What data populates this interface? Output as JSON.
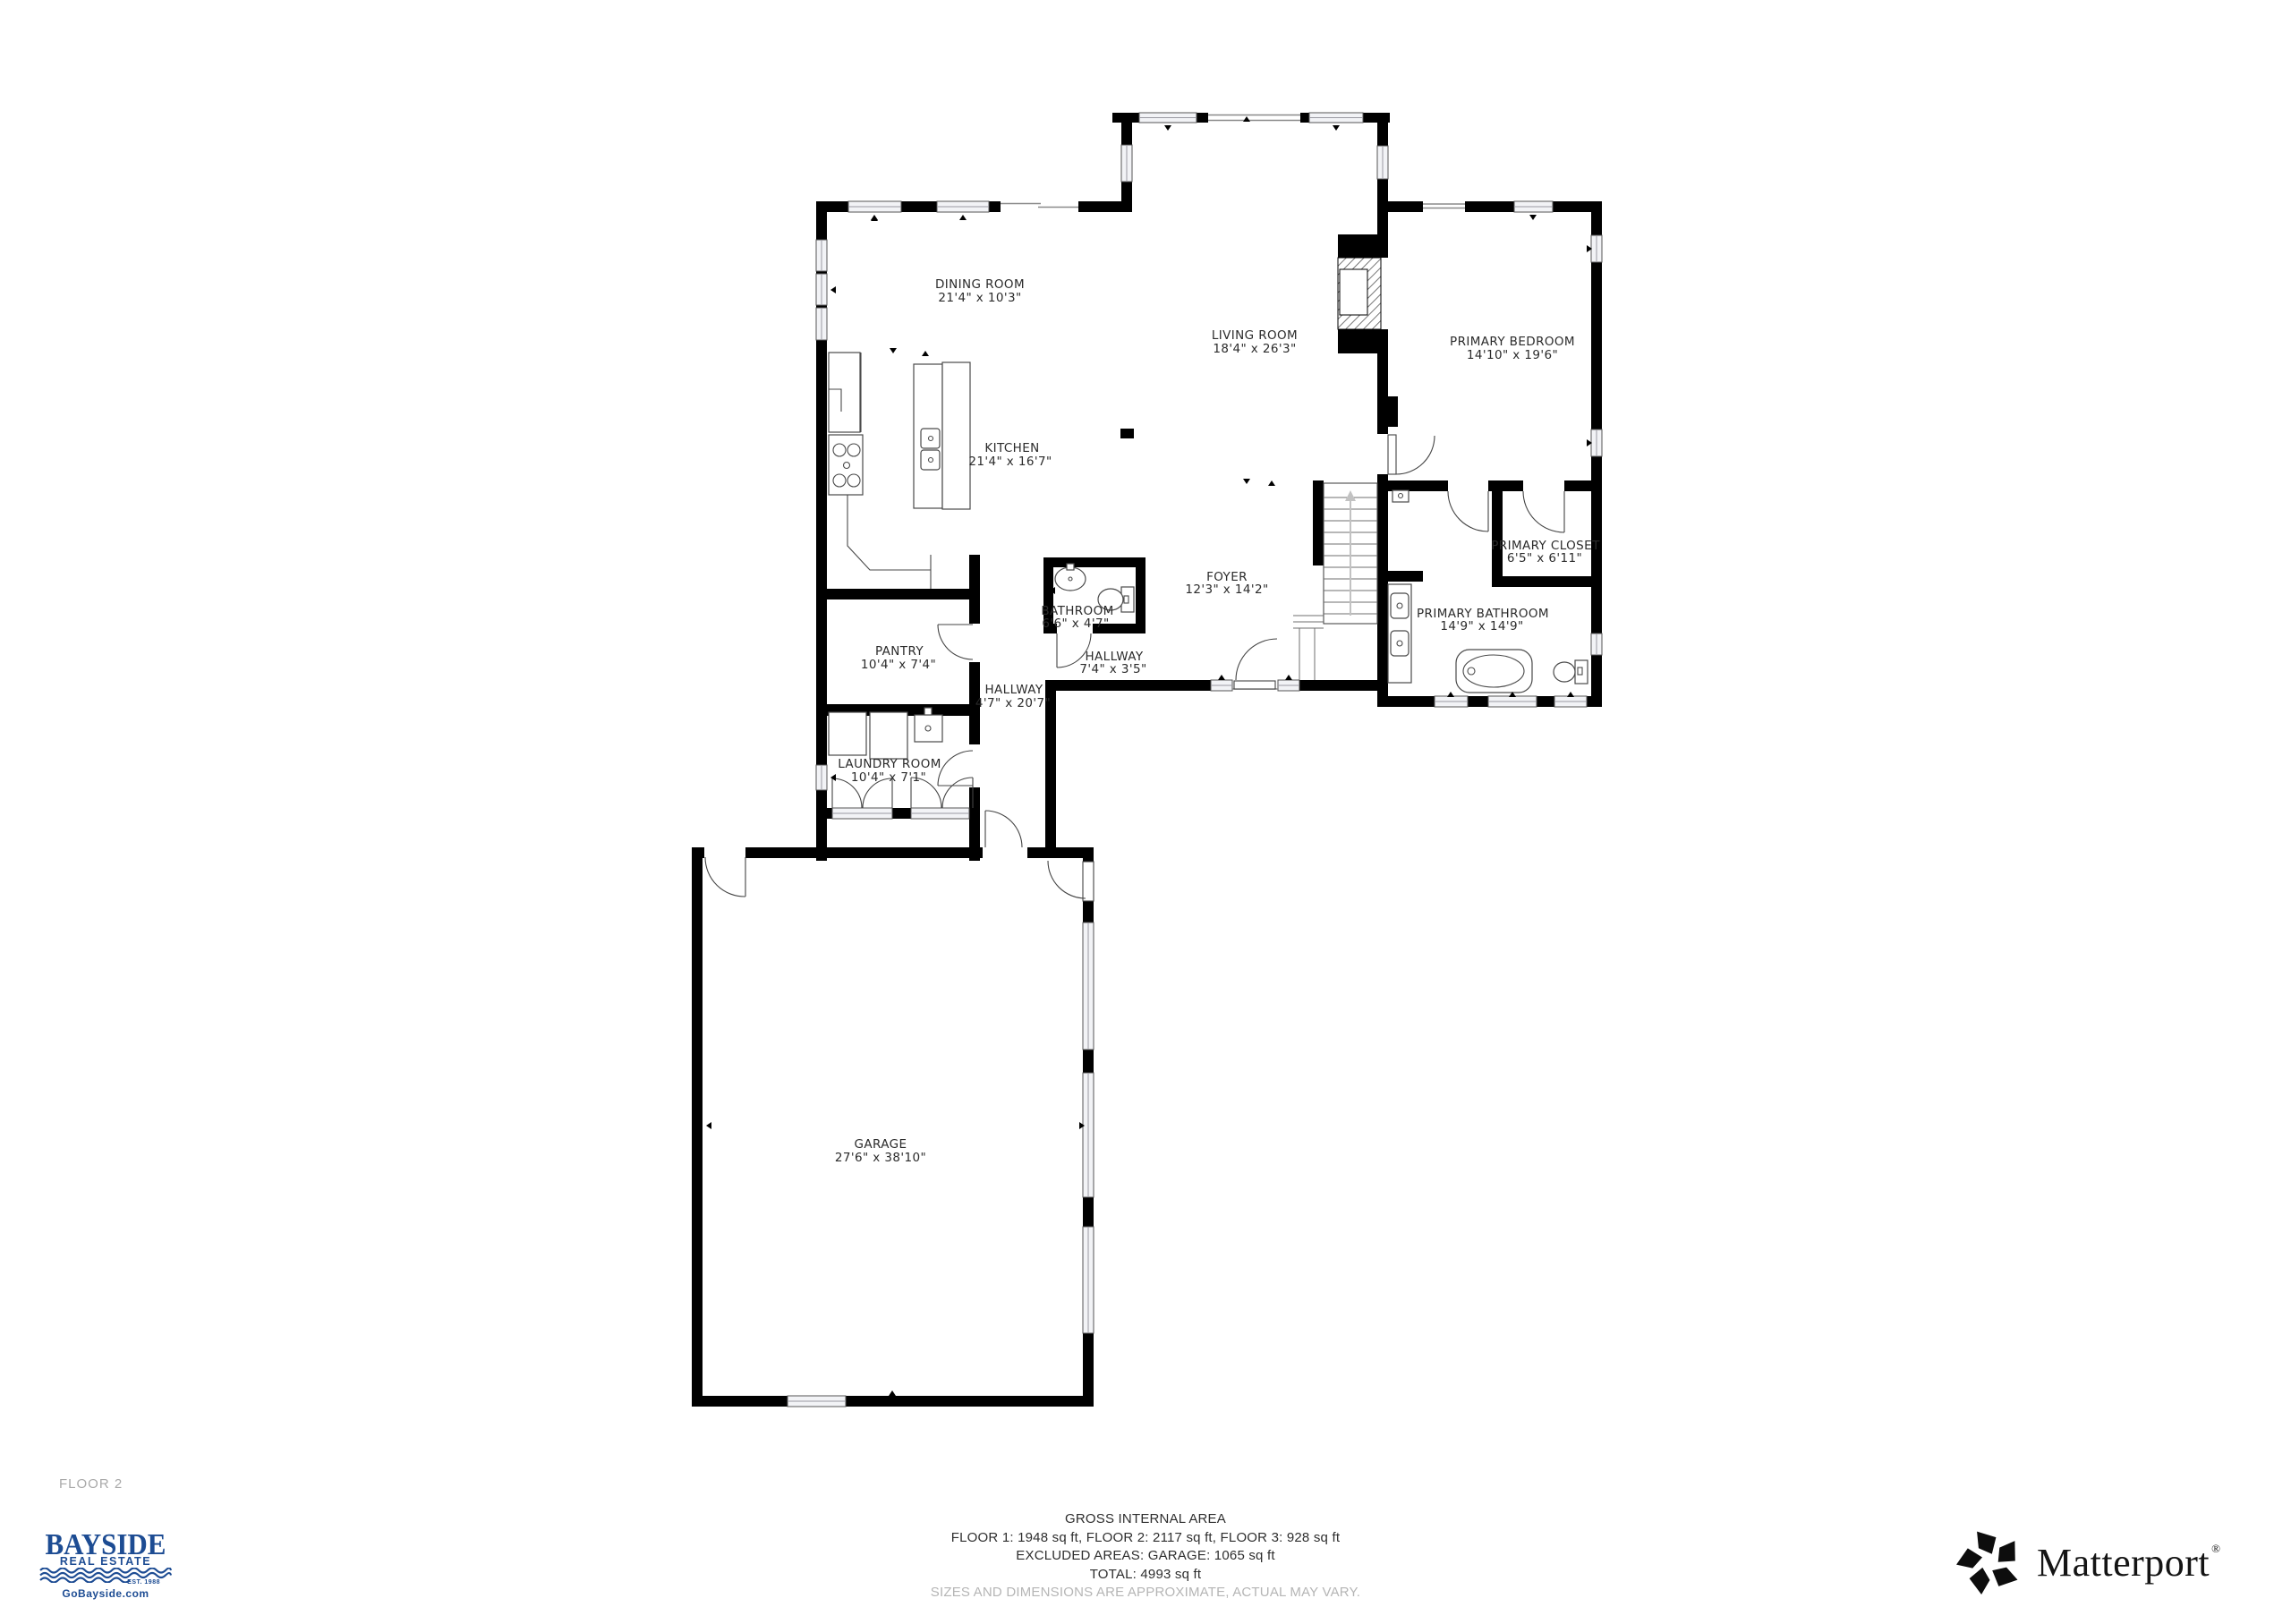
{
  "floor_plan": {
    "floor_label": "FLOOR 2",
    "rooms": [
      {
        "name": "DINING ROOM",
        "dims": "21'4\" x 10'3\""
      },
      {
        "name": "LIVING ROOM",
        "dims": "18'4\" x 26'3\""
      },
      {
        "name": "PRIMARY BEDROOM",
        "dims": "14'10\" x 19'6\""
      },
      {
        "name": "KITCHEN",
        "dims": "21'4\" x 16'7\""
      },
      {
        "name": "BATHROOM",
        "dims": "6'6\" x 4'7\""
      },
      {
        "name": "FOYER",
        "dims": "12'3\" x 14'2\""
      },
      {
        "name": "HALLWAY",
        "dims": "7'4\" x 3'5\""
      },
      {
        "name": "HALLWAY",
        "dims": "4'7\" x 20'7\""
      },
      {
        "name": "PANTRY",
        "dims": "10'4\" x 7'4\""
      },
      {
        "name": "LAUNDRY ROOM",
        "dims": "10'4\" x 7'1\""
      },
      {
        "name": "PRIMARY CLOSET",
        "dims": "6'5\" x 6'11\""
      },
      {
        "name": "PRIMARY BATHROOM",
        "dims": "14'9\" x 14'9\""
      },
      {
        "name": "GARAGE",
        "dims": "27'6\" x 38'10\""
      }
    ]
  },
  "footer": {
    "area_title": "GROSS INTERNAL AREA",
    "area_line1": "FLOOR 1: 1948 sq ft, FLOOR 2: 2117 sq ft, FLOOR 3: 928 sq ft",
    "area_line2": "EXCLUDED AREAS: GARAGE: 1065 sq ft",
    "area_line3": "TOTAL: 4993 sq ft",
    "disclaimer": "SIZES AND DIMENSIONS ARE APPROXIMATE, ACTUAL MAY VARY."
  },
  "branding": {
    "bayside": {
      "name": "BAYSIDE",
      "tagline": "REAL ESTATE",
      "established": "EST. 1988",
      "website": "GoBayside.com",
      "color": "#1d4c93"
    },
    "matterport": {
      "name": "Matterport",
      "registered": "®"
    }
  }
}
